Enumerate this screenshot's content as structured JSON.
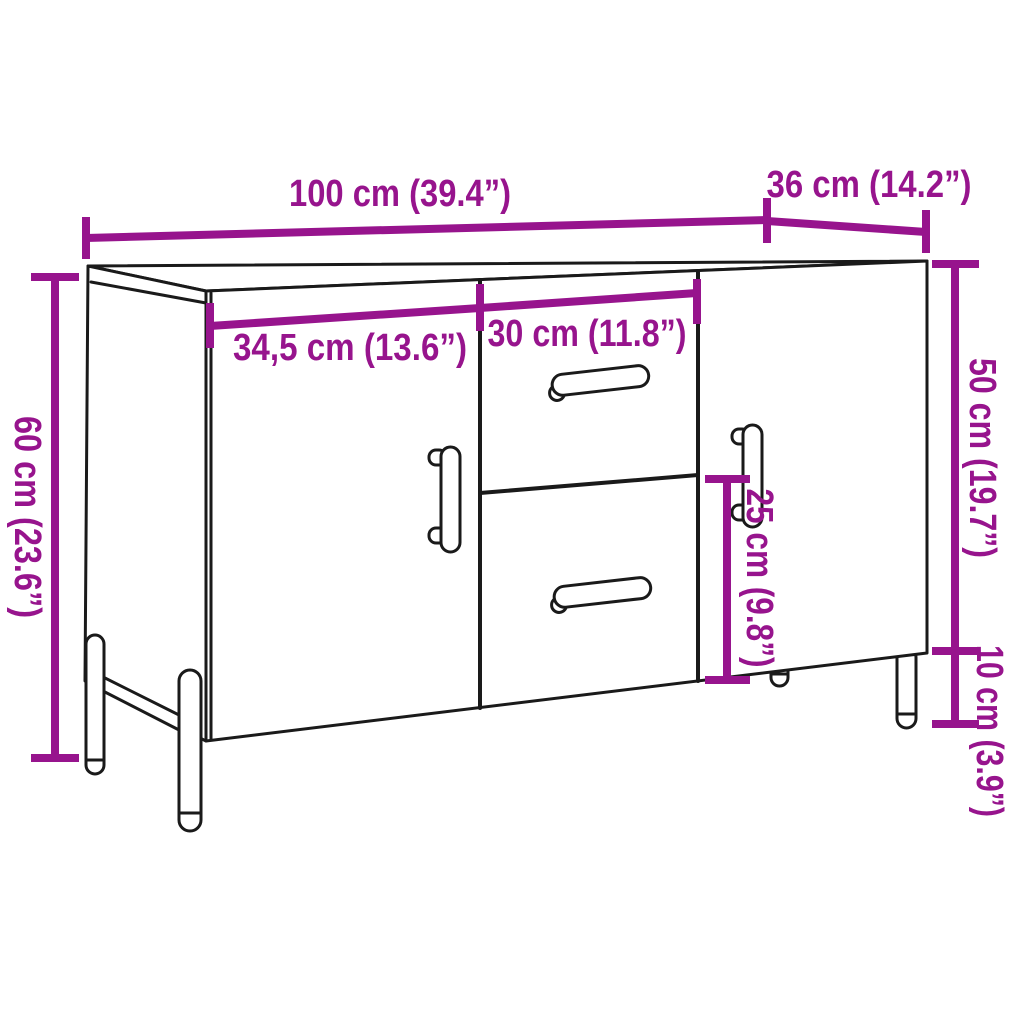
{
  "title": "Sideboard dimension diagram",
  "colors": {
    "dimension_accent": "#97148D",
    "line_art": "#1A1A1A",
    "background": "#FFFFFF"
  },
  "dimensions": {
    "overall_width": "100 cm (39.4”)",
    "depth": "36 cm (14.2”)",
    "overall_height": "60 cm (23.6”)",
    "left_door_width": "34,5 cm (13.6”)",
    "drawer_width": "30 cm (11.8”)",
    "body_height": "50 cm (19.7”)",
    "leg_height": "10 cm (3.9”)",
    "lower_section_height": "25 cm (9.8”)"
  }
}
